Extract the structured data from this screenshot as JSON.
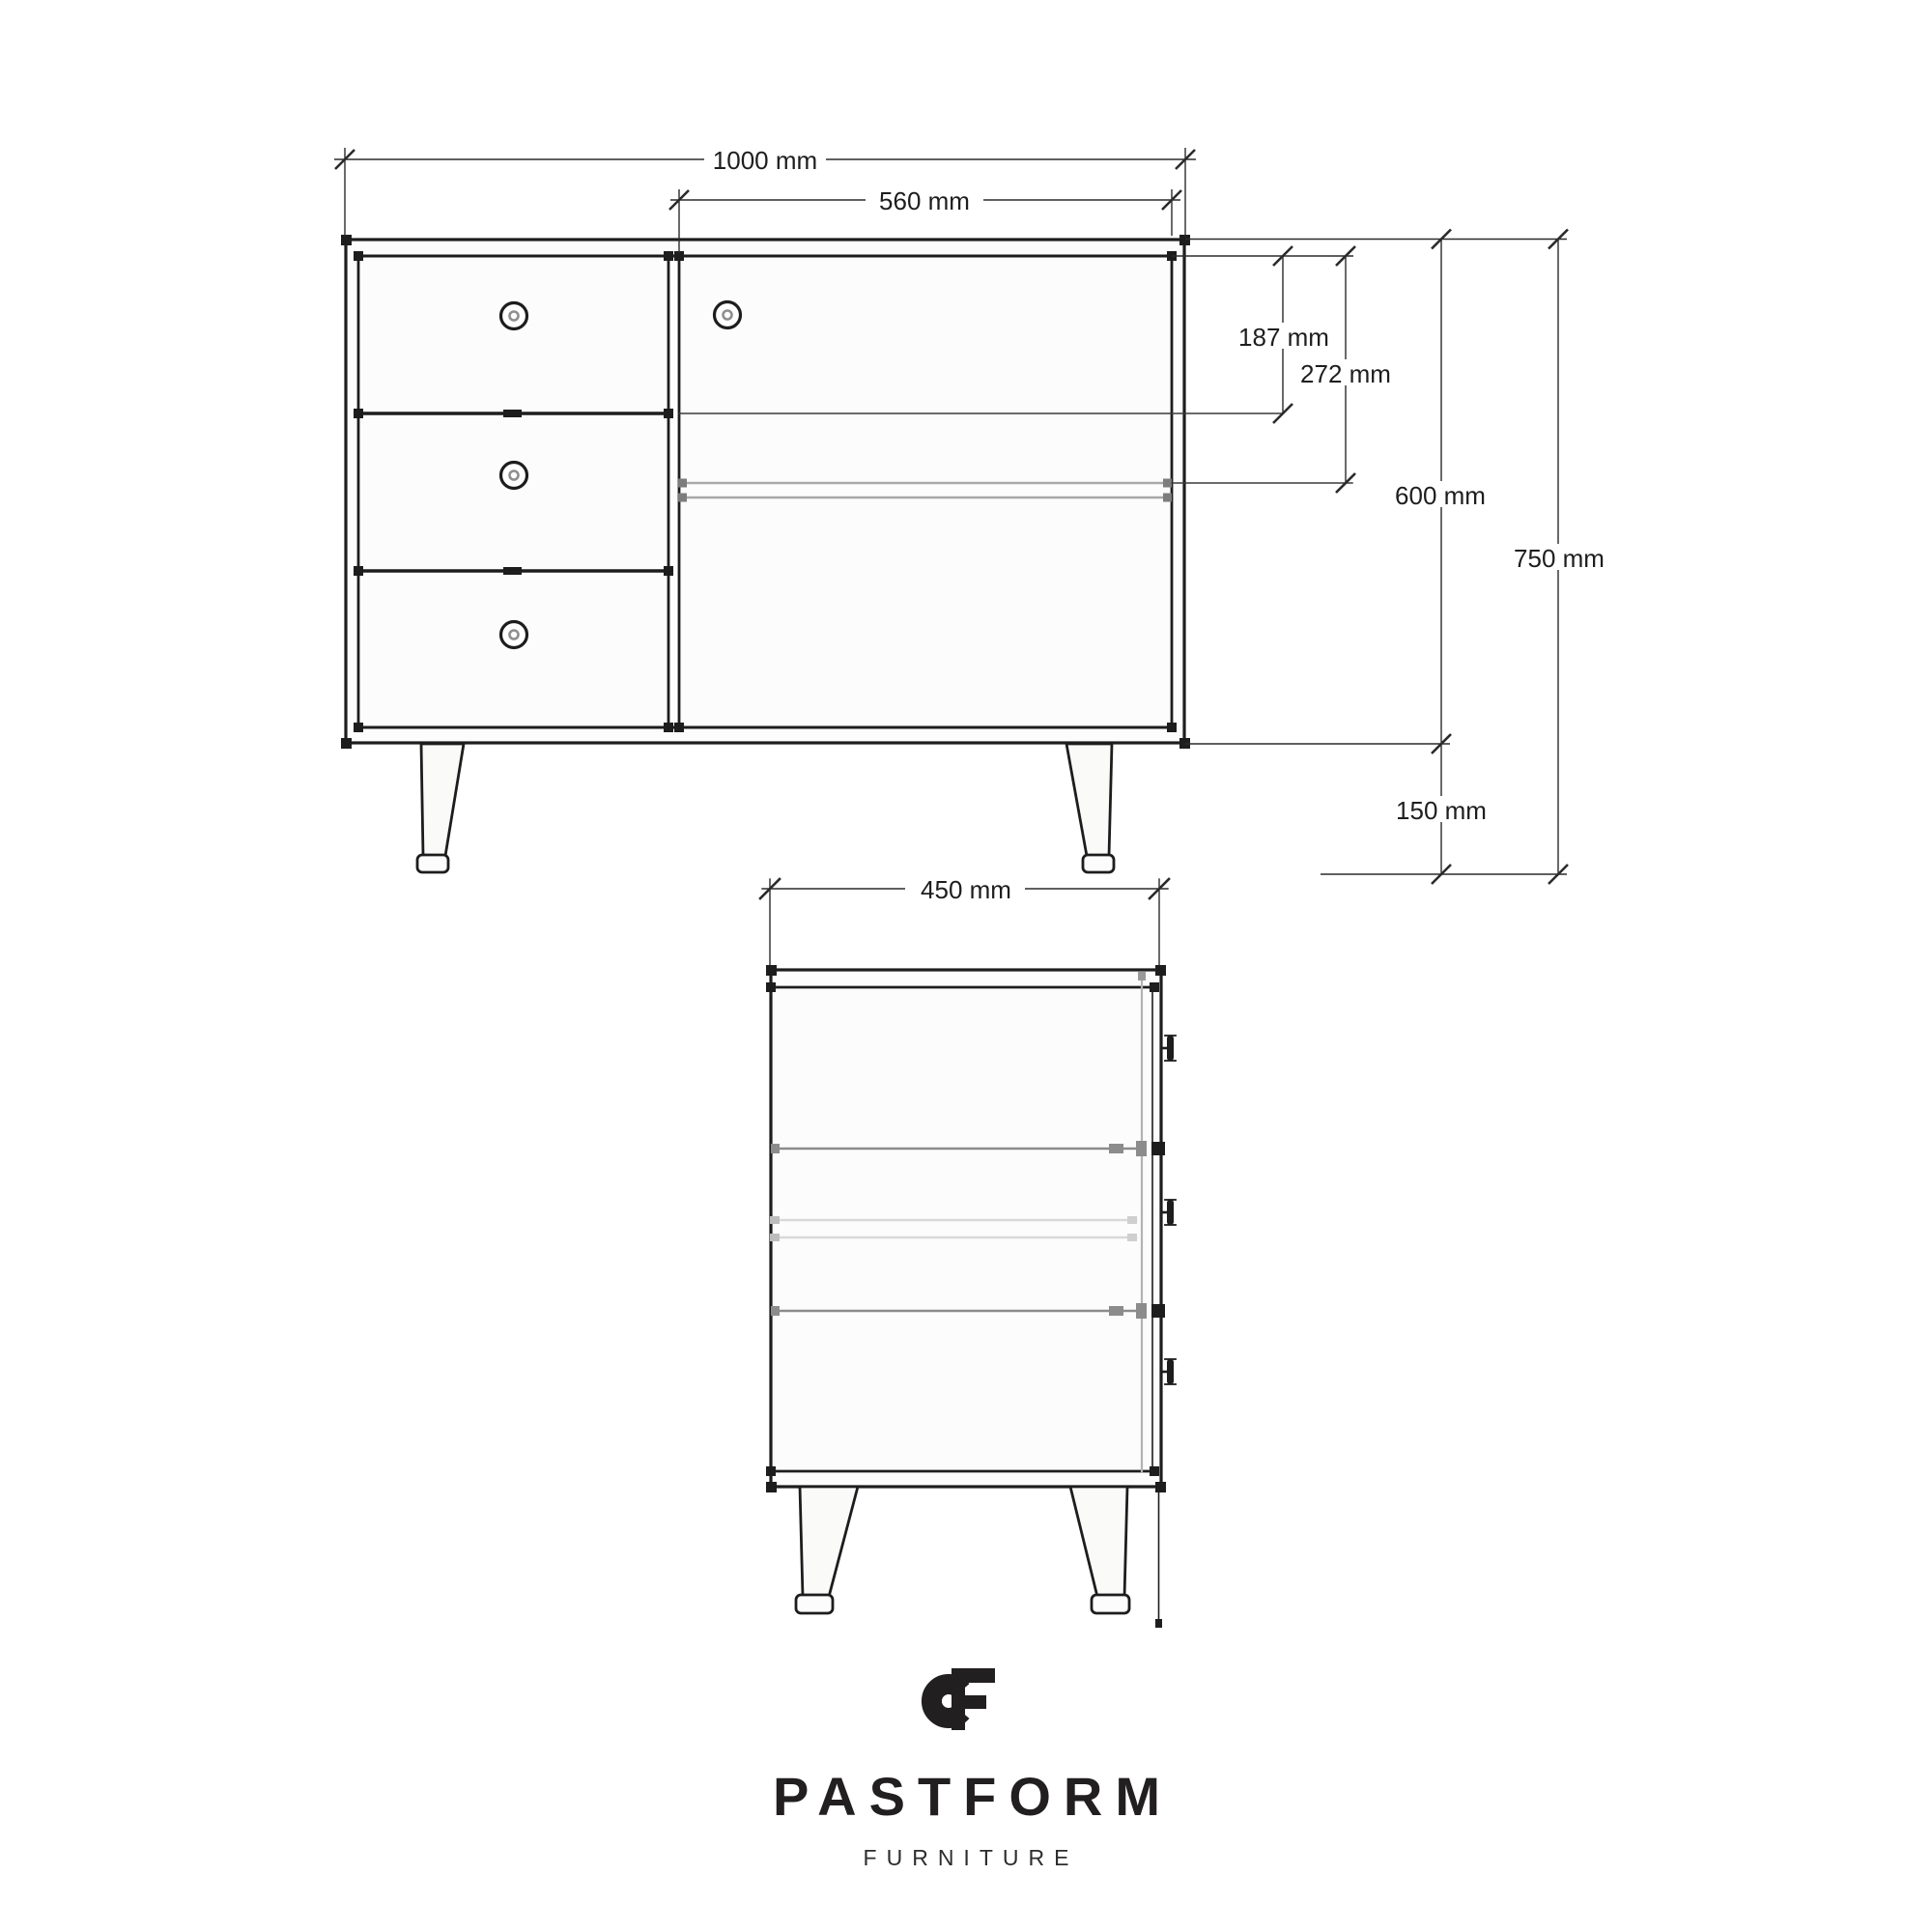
{
  "drawing": {
    "front_view": {
      "dim_overall_width": "1000 mm",
      "dim_door_width": "560 mm",
      "dim_drawer_height": "187 mm",
      "dim_shelf_position": "272 mm",
      "dim_carcass_height": "600 mm",
      "dim_overall_height": "750 mm",
      "dim_leg_height": "150 mm"
    },
    "side_view": {
      "dim_depth": "450 mm"
    }
  },
  "brand": {
    "name": "PASTFORM",
    "tagline": "FURNITURE"
  },
  "colors": {
    "line": "#1d1d1d",
    "dimension": "#2b2b2b",
    "grey_detail": "#8c8c8c",
    "light_detail": "#d9d9d9",
    "panel_fill": "#fbfcfb"
  }
}
